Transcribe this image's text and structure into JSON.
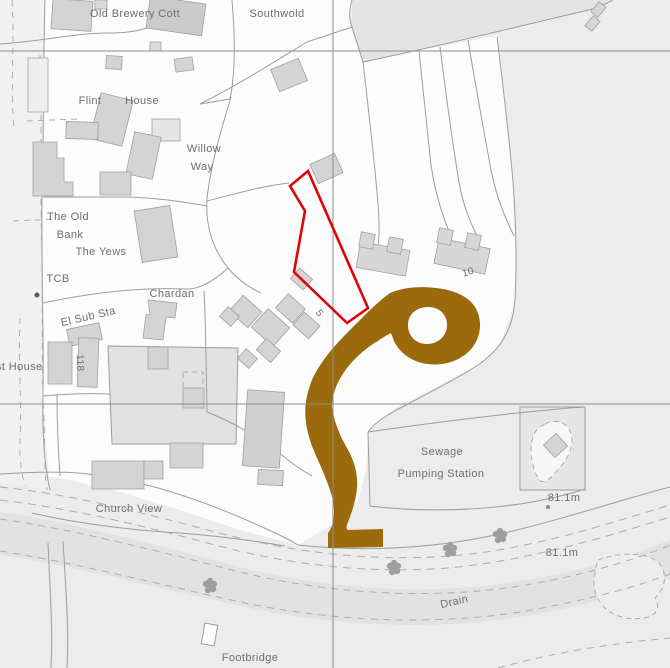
{
  "map": {
    "width": 670,
    "height": 668,
    "colors": {
      "background": "#ececec",
      "parcel_white": "#fcfcfc",
      "street_fill": "#f1f1f1",
      "field_fill": "#e4e4e4",
      "backland_fill": "#e2e2e2",
      "enclosure_fill": "#e6e6e6",
      "drain_fill": "#e2e2e2",
      "building_fill": "#d4d4d4",
      "building_stroke": "#a0a0a0",
      "line": "#9d9d9d",
      "dash": "#ababab",
      "grid": "#8d8d8d",
      "highlight_brown": "#9a6a0d",
      "plot_red": "#e00505",
      "text": "#6e6e6e",
      "tree": "#9e9e9e"
    },
    "regions": [
      {
        "name": "parcel-village-white",
        "path": "M0,0 L352,0 L350,26 L363,63 L420,50 L497,36 L513,182 L516,262 L515,300 L500,345 L478,365 L430,390 L395,408 L368,432 L366,470 L358,500 L340,520 L298,545 L240,530 L180,510 L120,492 L60,478 L0,474 Z",
        "fill": "#fcfcfc"
      },
      {
        "name": "street-strip",
        "path": "M0,0 L45,0 L43,198 L43,396 L50,490 L0,482 Z",
        "fill": "#f1f1f1"
      },
      {
        "name": "field-top",
        "path": "M352,0 L613,0 L597,8 L363,62 L352,27 Z",
        "fill": "#e4e4e4"
      },
      {
        "name": "backland-parcel",
        "path": "M108,346 L238,348 L236,444 L112,444 Z",
        "fill": "#e2e2e2"
      },
      {
        "name": "drain-band",
        "path": "M0,512 C70,522 150,543 240,567 C330,590 430,596 520,581 C590,570 640,552 670,540 L670,578 C642,590 590,605 520,617 C430,631 330,626 240,606 C150,586 70,565 0,555 Z",
        "fill": "#e2e2e2"
      },
      {
        "name": "drain-pond",
        "path": "M598,560 C620,552 645,552 658,562 C668,572 666,588 655,598 C660,606 658,614 648,617 C634,621 615,618 605,608 C595,598 592,585 595,574 C596,568 596,564 598,560 Z",
        "fill": "#ededed",
        "stroke": "#ababab",
        "dash": "5,4"
      },
      {
        "name": "pumping-enclosure",
        "path": "M520,407 L585,407 L585,490 L520,490 Z",
        "fill": "#e6e6e6",
        "stroke": "#9d9d9d"
      },
      {
        "name": "pumping-teardrop",
        "path": "M545,424 C559,417 571,425 572,439 C573,453 563,464 554,474 C548,481 542,485 538,478 C532,468 529,449 533,437 C536,428 540,427 545,424 Z",
        "fill": "#f7f7f7",
        "stroke": "#ababab",
        "dash": "5,4"
      },
      {
        "name": "glasshouse-dashed",
        "path": "M183,372 L203,372 L203,400 L183,400 Z",
        "fill": "none",
        "stroke": "#ababab",
        "dash": "5,4"
      }
    ],
    "lines": [
      {
        "name": "boundary-top-row",
        "path": "M0,44 C45,41 75,33 108,33 C138,33 155,28 167,14 L170,0"
      },
      {
        "name": "boundary-southwold-west",
        "path": "M232,0 C235,35 236,70 230,99"
      },
      {
        "name": "boundary-diagonal-road",
        "path": "M230,99 L200,104 C240,84 277,60 307,42 L352,27"
      },
      {
        "name": "boundary-field-west",
        "path": "M352,0 C349,10 349,19 352,27 L363,62"
      },
      {
        "name": "boundary-field-south",
        "path": "M363,62 C440,46 520,26 597,8 L613,0"
      },
      {
        "name": "strip-line-1",
        "path": "M419,51 C423,90 427,130 431,165 C436,198 444,220 452,238"
      },
      {
        "name": "strip-line-2",
        "path": "M440,47 C446,95 452,140 459,182 C463,205 470,222 478,238"
      },
      {
        "name": "strip-line-3",
        "path": "M468,40 C476,88 484,132 491,170 C496,196 505,218 514,236"
      },
      {
        "name": "boundary-east",
        "path": "M497,37 C503,85 509,135 513,182 C516,222 517,262 515,300 C513,330 500,350 478,365 C455,380 430,392 408,404 C390,413 375,422 368,432"
      },
      {
        "name": "boundary-field-to-plot",
        "path": "M363,62 C368,105 373,148 377,192 C379,215 380,232 378,246"
      },
      {
        "name": "boundary-willow-way-west",
        "path": "M231,97 C221,130 211,164 207,198 C205,230 215,252 228,268 C238,280 250,288 261,293"
      },
      {
        "name": "boundary-old-bank-south",
        "path": "M43,197 L130,197 C155,198 180,201 207,206"
      },
      {
        "name": "boundary-yews-south",
        "path": "M43,303 C90,293 140,287 185,289 C200,290 215,280 228,268"
      },
      {
        "name": "boundary-chardan-east",
        "path": "M204,291 C206,330 206,370 207,412"
      },
      {
        "name": "boundary-backland",
        "path": "M108,346 L238,348 L236,444 L112,444 L108,346"
      },
      {
        "name": "boundary-south-of-houses",
        "path": "M207,412 C235,423 262,439 283,456 C295,466 305,472 312,476"
      },
      {
        "name": "boundary-street-east",
        "path": "M45,0 C43,60 44,130 42,198 C41,266 44,330 43,396 C42,440 45,468 50,490"
      },
      {
        "name": "boundary-village-bottom",
        "path": "M0,474 C60,470 90,472 130,481 C180,492 225,510 262,527 C278,534 290,540 298,545"
      },
      {
        "name": "boundary-churchview-bottom",
        "path": "M32,513 C80,524 130,530 180,533 C220,536 255,541 285,546"
      },
      {
        "name": "boundary-churchview-west",
        "path": "M57,394 C57,420 58,448 60,476"
      },
      {
        "name": "boundary-churchview-north",
        "path": "M43,396 C65,394 88,393 110,394"
      },
      {
        "name": "road-north-edge",
        "path": "M298,545 C360,552 430,549 495,535 C555,522 620,500 670,487"
      },
      {
        "name": "sewage-parcel-top",
        "path": "M368,432 C430,423 500,414 570,408 L585,407"
      },
      {
        "name": "sewage-parcel-west",
        "path": "M368,432 L370,506"
      },
      {
        "name": "sewage-parcel-bottom",
        "path": "M370,506 C420,512 470,511 520,504 C545,500 570,494 585,489"
      },
      {
        "name": "footpath-left-1",
        "path": "M48,543 C50,590 53,630 51,668"
      },
      {
        "name": "footpath-left-2",
        "path": "M63,541 C66,590 69,630 67,668"
      },
      {
        "name": "boundary-near-apex",
        "path": "M207,201 C235,194 262,186 289,183"
      },
      {
        "name": "dashed-parish-1",
        "path": "M12,0 C15,45 10,88 14,128",
        "dash": "6,6"
      },
      {
        "name": "dashed-parish-2",
        "path": "M40,55 C42,120 40,190 42,258 C43,300 41,360 44,420 C45,452 44,470 47,490",
        "dash": "6,6"
      },
      {
        "name": "dashed-parish-3",
        "path": "M20,318 C18,360 22,402 20,442 C19,460 22,474 25,486",
        "dash": "6,6"
      },
      {
        "name": "dashed-hedge-1",
        "path": "M13,221 L60,219",
        "dash": "6,5"
      },
      {
        "name": "dashed-hedge-2",
        "path": "M27,121 L77,119",
        "dash": "6,5"
      },
      {
        "name": "dashed-lane-1",
        "path": "M0,487 C70,494 140,512 215,532 C290,552 370,562 450,556 C530,550 610,523 670,505",
        "dash": "8,6"
      },
      {
        "name": "dashed-lane-2",
        "path": "M0,500 C70,508 140,525 215,545 C290,565 368,574 448,568 C528,561 612,535 670,517",
        "dash": "8,6"
      },
      {
        "name": "dashed-drain-top",
        "path": "M0,519 C70,529 150,549 240,572 C330,594 430,600 520,586 C592,574 642,557 670,545",
        "dash": "7,6"
      },
      {
        "name": "dashed-drain-bottom",
        "path": "M0,551 C70,562 150,582 240,602 C330,621 430,626 520,612 C590,600 642,585 670,574",
        "dash": "7,6"
      },
      {
        "name": "dashed-below-drain",
        "path": "M498,668 C555,652 615,643 670,638",
        "dash": "7,6"
      }
    ],
    "buildings": [
      {
        "name": "building",
        "x": 52,
        "y": 0,
        "w": 40,
        "h": 30,
        "rot": 4
      },
      {
        "name": "building",
        "x": 148,
        "y": 0,
        "w": 56,
        "h": 32,
        "rot": 8,
        "fill": "#cbcbcb"
      },
      {
        "name": "building",
        "x": 95,
        "y": 0,
        "w": 12,
        "h": 9,
        "rot": 0,
        "fill": "#dcdcdc"
      },
      {
        "name": "building",
        "x": 28,
        "y": 58,
        "w": 20,
        "h": 54,
        "rot": 0,
        "fill": "#efefef"
      },
      {
        "name": "building",
        "x": 106,
        "y": 56,
        "w": 16,
        "h": 13,
        "rot": 3
      },
      {
        "name": "building",
        "x": 175,
        "y": 58,
        "w": 18,
        "h": 13,
        "rot": -8
      },
      {
        "name": "building",
        "x": 150,
        "y": 42,
        "w": 11,
        "h": 9,
        "rot": 0,
        "fill": "#dcdcdc"
      },
      {
        "name": "building",
        "x": 95,
        "y": 96,
        "w": 33,
        "h": 47,
        "rot": 14
      },
      {
        "name": "building",
        "x": 66,
        "y": 122,
        "w": 32,
        "h": 17,
        "rot": 2
      },
      {
        "name": "building",
        "x": 152,
        "y": 119,
        "w": 28,
        "h": 22,
        "rot": 0,
        "fill": "#e6e6e6"
      },
      {
        "name": "building",
        "x": 130,
        "y": 134,
        "w": 27,
        "h": 43,
        "rot": 12
      },
      {
        "name": "building",
        "x": 100,
        "y": 172,
        "w": 31,
        "h": 23,
        "rot": 0
      },
      {
        "name": "building",
        "path": "M33,142 L57,142 L57,158 L64,158 L64,182 L73,182 L73,196 L33,196 Z"
      },
      {
        "name": "building",
        "x": 138,
        "y": 208,
        "w": 36,
        "h": 52,
        "rot": -9
      },
      {
        "name": "building",
        "x": 274,
        "y": 63,
        "w": 30,
        "h": 24,
        "rot": -22
      },
      {
        "name": "building",
        "x": 313,
        "y": 158,
        "w": 27,
        "h": 21,
        "rot": -24
      },
      {
        "name": "building",
        "x": 68,
        "y": 326,
        "w": 33,
        "h": 17,
        "rot": -12
      },
      {
        "name": "building",
        "x": 78,
        "y": 338,
        "w": 20,
        "h": 49,
        "rot": 2
      },
      {
        "name": "building",
        "x": 48,
        "y": 342,
        "w": 24,
        "h": 42,
        "rot": 0
      },
      {
        "name": "building",
        "path": "M148,300 L177,303 L175,318 L166,317 L163,340 L143,338 L146,315 L150,314 Z"
      },
      {
        "name": "building",
        "x": 148,
        "y": 347,
        "w": 20,
        "h": 22,
        "rot": 0
      },
      {
        "name": "building",
        "x": 233,
        "y": 301,
        "w": 25,
        "h": 21,
        "rot": 42
      },
      {
        "name": "building",
        "x": 256,
        "y": 315,
        "w": 29,
        "h": 25,
        "rot": 42
      },
      {
        "name": "building",
        "x": 279,
        "y": 299,
        "w": 23,
        "h": 19,
        "rot": 42
      },
      {
        "name": "building",
        "x": 296,
        "y": 317,
        "w": 21,
        "h": 17,
        "rot": 42
      },
      {
        "name": "building",
        "x": 259,
        "y": 343,
        "w": 19,
        "h": 15,
        "rot": 42
      },
      {
        "name": "building",
        "x": 240,
        "y": 352,
        "w": 15,
        "h": 13,
        "rot": 42
      },
      {
        "name": "building",
        "x": 222,
        "y": 310,
        "w": 15,
        "h": 13,
        "rot": 42
      },
      {
        "name": "building",
        "x": 293,
        "y": 272,
        "w": 17,
        "h": 14,
        "rot": 42
      },
      {
        "name": "building",
        "x": 358,
        "y": 246,
        "w": 50,
        "h": 26,
        "rot": 10,
        "fill": "#d7d7d7"
      },
      {
        "name": "building",
        "x": 360,
        "y": 233,
        "w": 14,
        "h": 15,
        "rot": 10,
        "fill": "#d7d7d7"
      },
      {
        "name": "building",
        "x": 388,
        "y": 238,
        "w": 14,
        "h": 15,
        "rot": 10,
        "fill": "#d7d7d7"
      },
      {
        "name": "building",
        "x": 436,
        "y": 243,
        "w": 52,
        "h": 26,
        "rot": 12,
        "fill": "#d7d7d7"
      },
      {
        "name": "building",
        "x": 438,
        "y": 229,
        "w": 14,
        "h": 15,
        "rot": 12,
        "fill": "#d7d7d7"
      },
      {
        "name": "building",
        "x": 466,
        "y": 234,
        "w": 14,
        "h": 15,
        "rot": 12,
        "fill": "#d7d7d7"
      },
      {
        "name": "building",
        "x": 547,
        "y": 437,
        "w": 17,
        "h": 17,
        "rot": -42
      },
      {
        "name": "building",
        "x": 92,
        "y": 461,
        "w": 52,
        "h": 28,
        "rot": 0
      },
      {
        "name": "building",
        "x": 144,
        "y": 461,
        "w": 19,
        "h": 18,
        "rot": 0
      },
      {
        "name": "building",
        "x": 170,
        "y": 443,
        "w": 33,
        "h": 25,
        "rot": 0
      },
      {
        "name": "building",
        "x": 183,
        "y": 388,
        "w": 21,
        "h": 20,
        "rot": 0
      },
      {
        "name": "building",
        "x": 245,
        "y": 391,
        "w": 37,
        "h": 76,
        "rot": 4,
        "fill": "#d0d0d0"
      },
      {
        "name": "building",
        "x": 258,
        "y": 470,
        "w": 25,
        "h": 15,
        "rot": 3
      },
      {
        "name": "building",
        "x": 594,
        "y": 3,
        "w": 9,
        "h": 13,
        "rot": 40,
        "fill": "#d6d6d6"
      },
      {
        "name": "building",
        "x": 588,
        "y": 17,
        "w": 9,
        "h": 13,
        "rot": 40,
        "fill": "#d6d6d6"
      }
    ],
    "trees": [
      [
        210,
        586
      ],
      [
        394,
        568
      ],
      [
        450,
        550
      ],
      [
        500,
        536
      ]
    ],
    "grid": {
      "h": [
        51,
        404
      ],
      "v": [
        333
      ]
    },
    "highlight": {
      "name": "highlighted-road",
      "path": "M390,293 C404,287 420,286 436,288 C463,291 479,303 480,323 C481,345 464,361 442,364 C419,367 401,356 394,341 L391,333 C378,340 364,349 353,361 C340,375 332,391 332,407 C334,420 338,432 347,448 C355,462 358,475 357,488 C356,500 352,512 348,522 C346,527 346,529 348,530 L383,529 L383,547 L328,548 L328,533 C332,528 334,520 334,512 C334,498 329,487 324,474 C317,457 308,441 306,422 C304,409 306,395 312,380 C320,362 334,346 350,330 C362,318 376,303 390,293 Z M447,325 C447,336 438,344 427,344 C416,344 408,336 408,325 C408,314 417,307 428,307 C439,307 447,314 447,325 Z"
    },
    "red_plot": {
      "name": "plot-outline",
      "points": "308,171 290,186 305,211 294,272 347,323 368,308",
      "stroke_width": 2.6
    },
    "labels": [
      {
        "name": "label-old-brewery-cott",
        "text": "Old Brewery Cott",
        "x": 135,
        "y": 17
      },
      {
        "name": "label-southwold",
        "text": "Southwold",
        "x": 277,
        "y": 17
      },
      {
        "name": "label-flint",
        "text": "Flint",
        "x": 90,
        "y": 104
      },
      {
        "name": "label-house",
        "text": "House",
        "x": 142,
        "y": 104
      },
      {
        "name": "label-willow",
        "text": "Willow",
        "x": 204,
        "y": 152
      },
      {
        "name": "label-way",
        "text": "Way",
        "x": 202,
        "y": 170
      },
      {
        "name": "label-the-old",
        "text": "The Old",
        "x": 68,
        "y": 220
      },
      {
        "name": "label-bank",
        "text": "Bank",
        "x": 70,
        "y": 238
      },
      {
        "name": "label-the-yews",
        "text": "The Yews",
        "x": 101,
        "y": 255
      },
      {
        "name": "label-tcb",
        "text": "TCB",
        "x": 58,
        "y": 282
      },
      {
        "name": "label-chardan",
        "text": "Chardan",
        "x": 172,
        "y": 297
      },
      {
        "name": "label-el-sub-sta",
        "text": "El Sub Sta",
        "x": 89,
        "y": 320,
        "rot": -13
      },
      {
        "name": "label-st-house",
        "text": "st House",
        "x": -4,
        "y": 370,
        "anchor": "start"
      },
      {
        "name": "label-118",
        "text": "118",
        "x": 77,
        "y": 363,
        "rot": 88,
        "size": 10
      },
      {
        "name": "label-5",
        "text": "5",
        "x": 317,
        "y": 315,
        "rot": 55,
        "size": 10
      },
      {
        "name": "label-way-street",
        "text": "WAY",
        "x": 371,
        "y": 345,
        "rot": -27,
        "size": 10,
        "spacing": "2",
        "under": true
      },
      {
        "name": "label-10",
        "text": "10",
        "x": 469,
        "y": 275,
        "rot": -18,
        "size": 10
      },
      {
        "name": "label-sewage",
        "text": "Sewage",
        "x": 442,
        "y": 455
      },
      {
        "name": "label-pumping-station",
        "text": "Pumping Station",
        "x": 441,
        "y": 477
      },
      {
        "name": "label-church-view",
        "text": "Church View",
        "x": 129,
        "y": 512
      },
      {
        "name": "label-height-1",
        "text": "81.1m",
        "x": 564,
        "y": 501
      },
      {
        "name": "label-height-2",
        "text": "81.1m",
        "x": 562,
        "y": 556
      },
      {
        "name": "label-drain",
        "text": "Drain",
        "x": 455,
        "y": 605,
        "rot": -13
      },
      {
        "name": "label-footbridge",
        "text": "Footbridge",
        "x": 250,
        "y": 661
      }
    ],
    "markers": {
      "boundary_dot": {
        "name": "boundary-marker-dot",
        "x": 37,
        "y": 295,
        "r": 2.5,
        "fill": "#5a5a5a"
      },
      "benchmark_dot": {
        "name": "benchmark-dot",
        "x": 548,
        "y": 507,
        "r": 2,
        "fill": "#8a8a8a"
      },
      "footbridge": {
        "name": "footbridge-symbol",
        "x": 203,
        "y": 624,
        "w": 13,
        "h": 21,
        "rot": 10
      }
    }
  }
}
